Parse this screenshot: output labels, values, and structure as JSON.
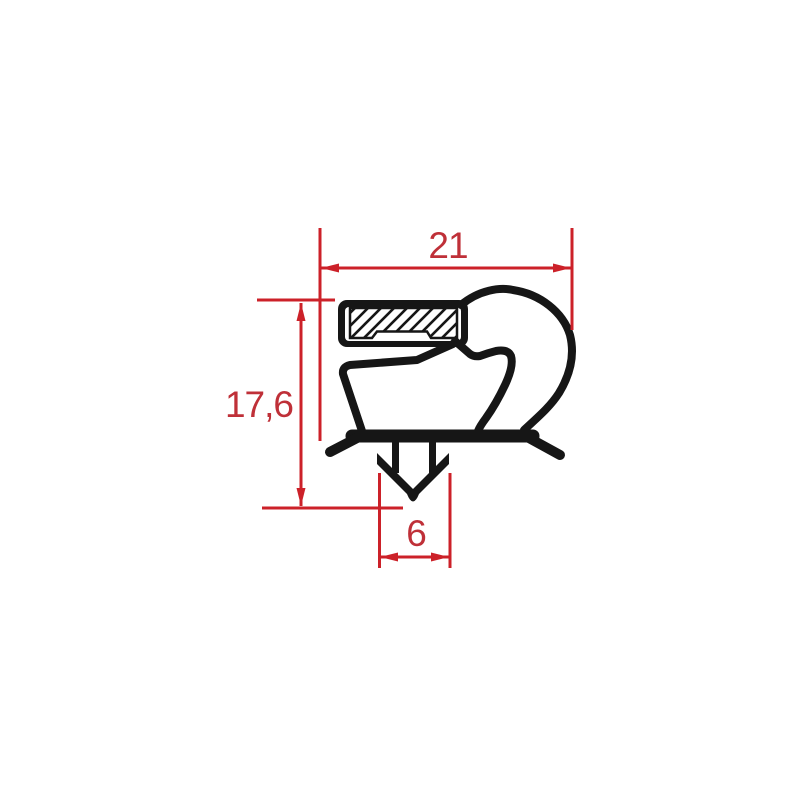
{
  "colors": {
    "dimension_red": "#cc2129",
    "dimension_text_red": "#bf3038",
    "profile_black": "#161616",
    "background": "#ffffff"
  },
  "diagram": {
    "type": "technical-drawing",
    "subject": "gasket-profile-cross-section",
    "dimensions": {
      "total_width": {
        "label": "21"
      },
      "total_height": {
        "label": "17,6"
      },
      "anchor_width": {
        "label": "6"
      }
    }
  }
}
